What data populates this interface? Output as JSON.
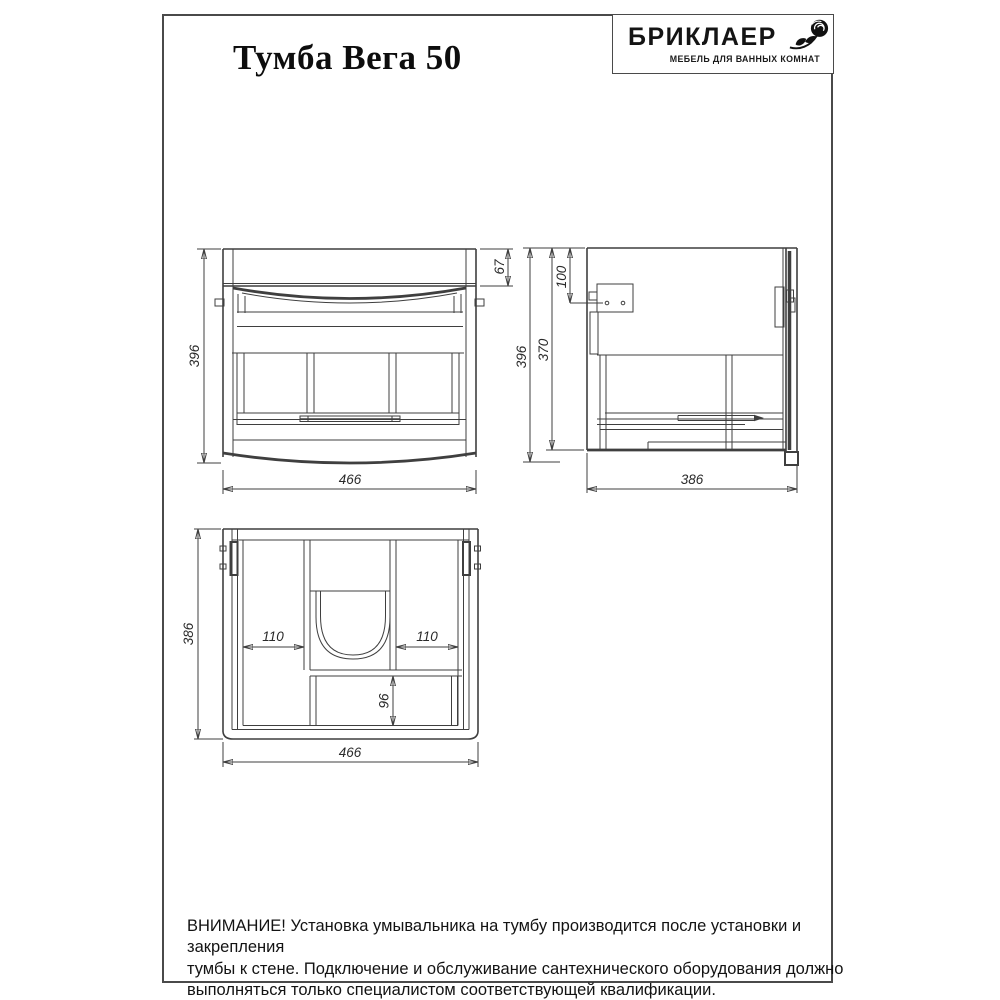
{
  "header": {
    "title": "Тумба Вега 50",
    "brand_name": "БРИКЛАЕР",
    "brand_tagline": "МЕБЕЛЬ ДЛЯ ВАННЫХ КОМНАТ",
    "brand_icon": "rose-icon"
  },
  "drawing": {
    "front_view": {
      "height_mm": "396",
      "width_mm": "466",
      "top_rail_mm": "67"
    },
    "side_view": {
      "height_mm": "396",
      "body_height_mm": "370",
      "mount_offset_mm": "100",
      "depth_mm": "386"
    },
    "top_view": {
      "depth_mm": "386",
      "width_mm": "466",
      "left_section_mm": "110",
      "right_section_mm": "110",
      "back_section_mm": "96"
    }
  },
  "warning": {
    "lines": [
      "ВНИМАНИЕ! Установка умывальника на тумбу производится после установки и закрепления",
      "тумбы к стене. Подключение и обслуживание сантехнического оборудования должно",
      "выполняться только специалистом соответствующей квалификации."
    ]
  },
  "colors": {
    "line": "#3f3f3f",
    "border": "#4a4a4a",
    "text": "#131313",
    "background": "#ffffff"
  }
}
